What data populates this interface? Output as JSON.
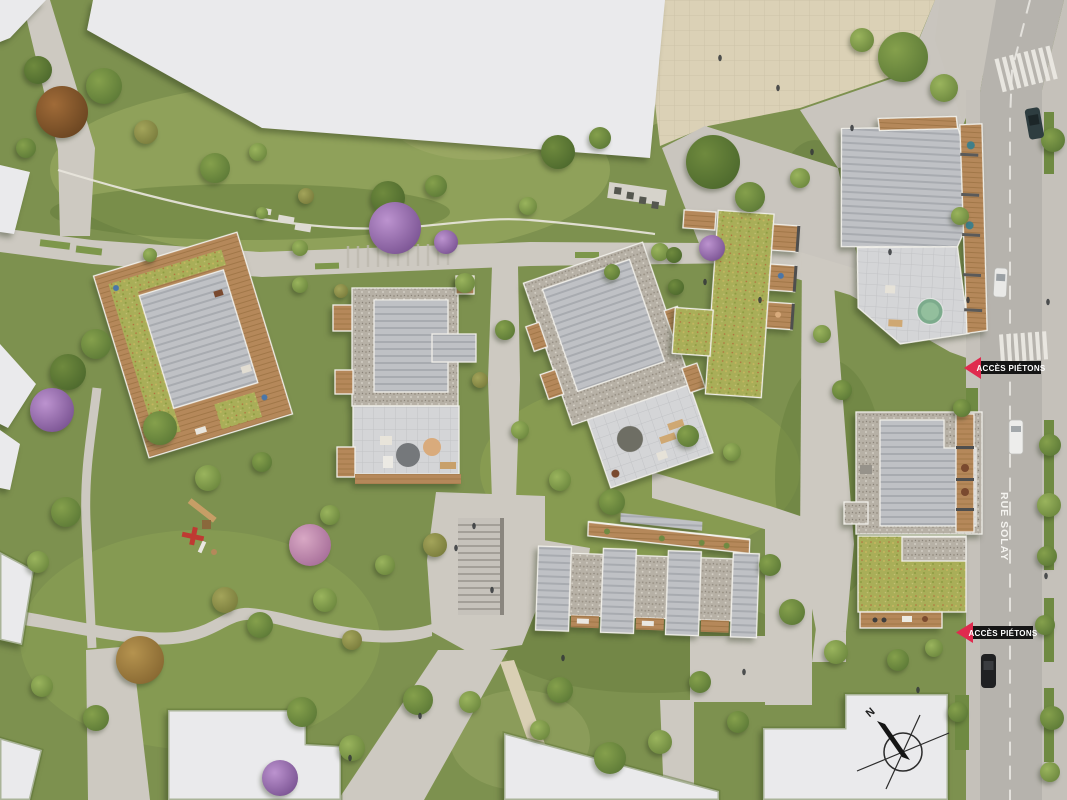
{
  "map": {
    "street": {
      "name": "RUE SOLAY"
    },
    "annotations": [
      {
        "id": "acces-pietons-top",
        "text": "ACCÈS PIÉTONS"
      },
      {
        "id": "acces-pietons-bottom",
        "text": "ACCÈS PIÉTONS"
      }
    ],
    "compass": {
      "label": "N"
    }
  },
  "colors": {
    "annotation_bg": "#151515",
    "annotation_text": "#ffffff",
    "annotation_marker": "#e02a4e",
    "grass": "#7d914f",
    "footpath": "#cdc9c1",
    "road": "#b6b3ad",
    "plaza_beige": "#dbd1b6",
    "white_building": "#eaeaec",
    "roof_gray": "#bfc1c5",
    "green_roof": "#a9ae58",
    "wood_deck": "#b5885a"
  }
}
